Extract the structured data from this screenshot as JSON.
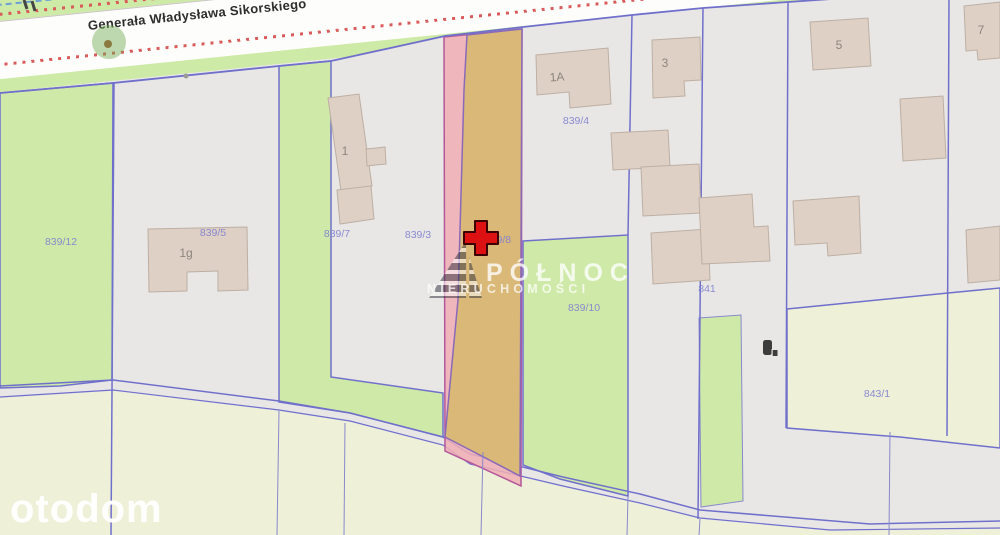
{
  "map": {
    "street_name": "Generała Władysława Sikorskiego",
    "parcel_labels": [
      {
        "id": "839/12",
        "text": "839/12"
      },
      {
        "id": "839/5",
        "text": "839/5"
      },
      {
        "id": "839/7",
        "text": "839/7"
      },
      {
        "id": "839/3",
        "text": "839/3"
      },
      {
        "id": "839/8",
        "text": "839/8"
      },
      {
        "id": "839/4",
        "text": "839/4"
      },
      {
        "id": "839/10",
        "text": "839/10"
      },
      {
        "id": "841",
        "text": "841"
      },
      {
        "id": "843/1",
        "text": "843/1"
      }
    ],
    "building_labels": [
      {
        "id": "1g",
        "text": "1g"
      },
      {
        "id": "1",
        "text": "1"
      },
      {
        "id": "1A",
        "text": "1A"
      },
      {
        "id": "3",
        "text": "3"
      },
      {
        "id": "5",
        "text": "5"
      },
      {
        "id": "7",
        "text": "7"
      }
    ],
    "marker": {
      "type": "red-cross",
      "parcel": "839/8"
    },
    "colors": {
      "base_parcel": "#e8e7e5",
      "green_parcel": "#cfeaa8",
      "yellow_parcel": "#eef0d8",
      "highlight_fill": "#d9b878",
      "highlight_outline_fill": "#f0aeb4",
      "boundary_line": "#7070cc",
      "road_fill": "#fdfdfb",
      "road_dotted": "#d95c5c",
      "road_dashed": "#6d9ed6",
      "building_fill": "#ded0c5",
      "marker_red": "#dd1111"
    }
  },
  "watermarks": {
    "center_line1": "PÓŁNOC",
    "center_line2": "NIERUCHOMOŚCI",
    "bottom_left": "otodom"
  }
}
